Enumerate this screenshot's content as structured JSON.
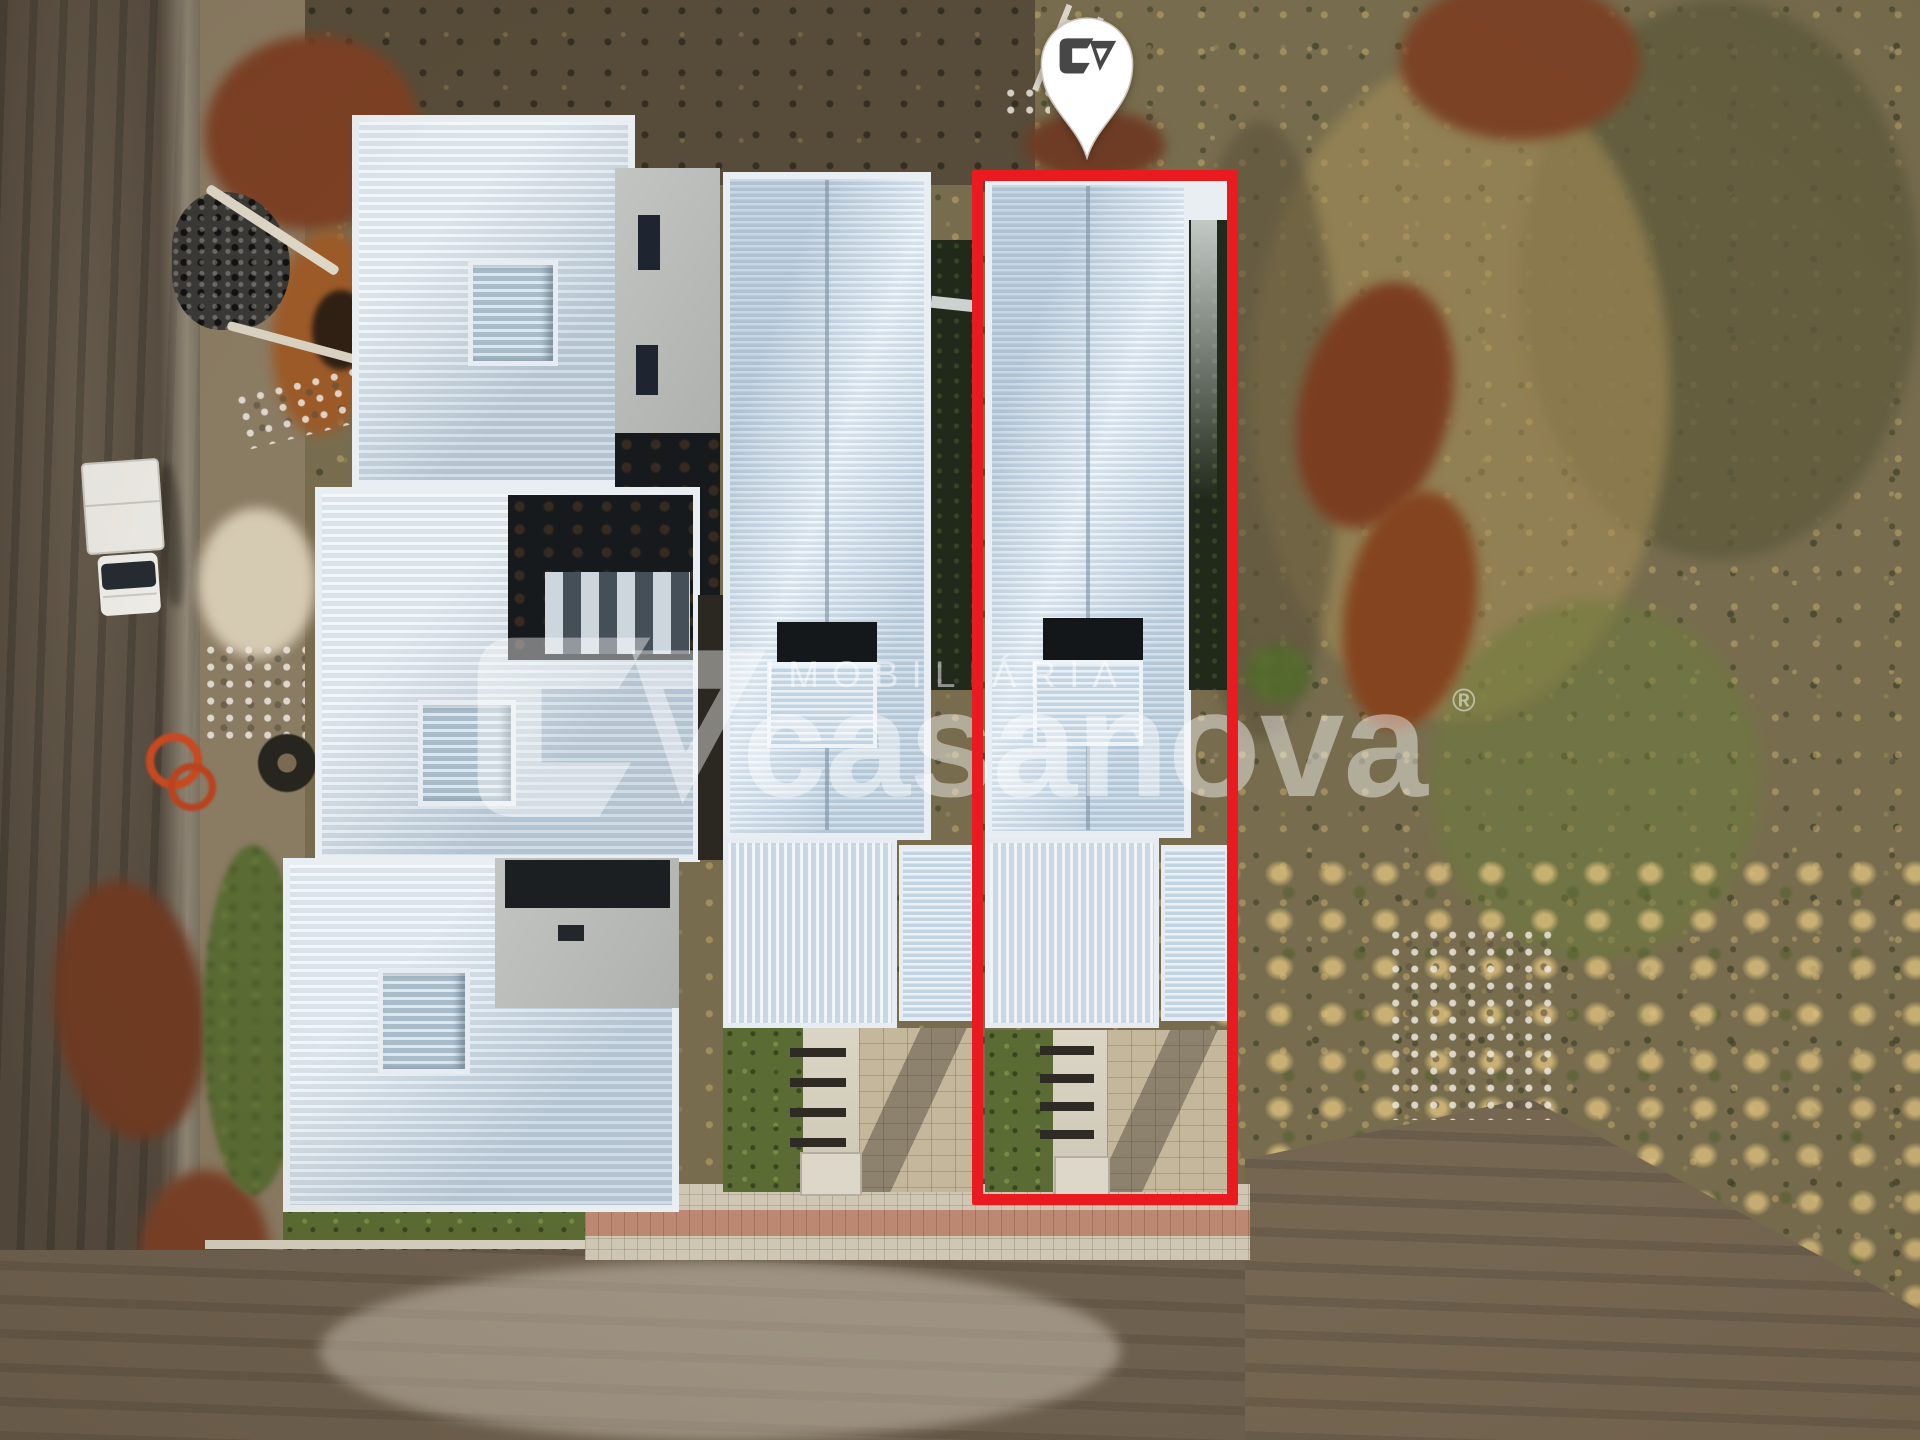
{
  "watermark": {
    "kicker": "IMOBILIÁRIA",
    "brand": "casanova",
    "registered_mark": "®"
  },
  "highlight": {
    "outline_color": "#ea1b20"
  },
  "pin": {
    "fill_color": "#ffffff",
    "logo_color": "#474747",
    "logo_name": "casanova-monogram"
  },
  "palette": {
    "roof_light": "#edf3f7",
    "roof_rib": "#c6d4df",
    "scrub": "#776d4e",
    "road": "#52483c",
    "red_dirt": "#7c3e22",
    "grass": "#5a6b33",
    "paver": "#c5b79c",
    "sidewalk": "#cfc7b4",
    "concrete": "#b9bcb8",
    "watermark_white": "rgba(255,255,255,0.48)"
  }
}
